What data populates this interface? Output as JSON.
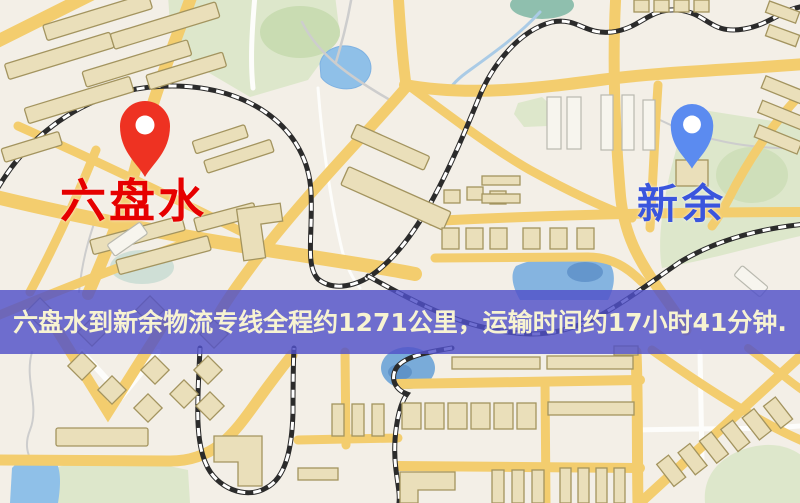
{
  "map": {
    "origin": {
      "label": "六盘水"
    },
    "destination": {
      "label": "新余"
    }
  },
  "banner": {
    "text": "六盘水到新余物流专线全程约1271公里，运输时间约17小时41分钟.",
    "route": "六盘水到新余物流专线",
    "distance": "约1271公里",
    "duration": "约17小时41分钟"
  },
  "colors": {
    "map_base": "#f3efe7",
    "banner_bg": "rgba(80,80,200,0.82)",
    "banner_text": "#f7f3d2",
    "origin_label": "#e60000",
    "destination_label": "#3a55dd",
    "origin_pin": "#ee3222",
    "destination_pin": "#5b8bf0",
    "road": "#f3cd6e",
    "park": "#dde7cb",
    "water": "#8fc0e8",
    "building": "#eadfba",
    "railway": "#2b2b2b"
  }
}
